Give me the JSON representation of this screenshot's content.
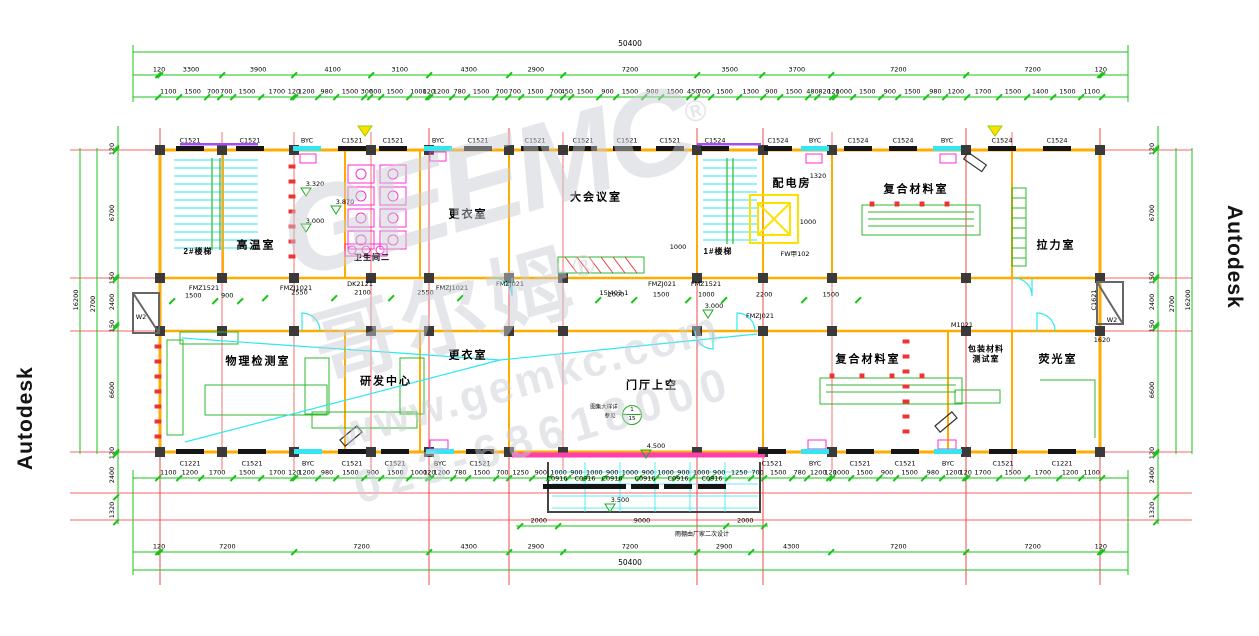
{
  "watermarks": {
    "left_vertical": "Autodesk",
    "right_vertical": "Autodesk",
    "center_logo_latin": "GEEMC",
    "center_logo_cn": "哥尔姆",
    "registered_mark": "®",
    "center_site": "www.gemkc.com",
    "center_phone": "023-68618000"
  },
  "rooms": {
    "gaowen": "高温室",
    "weishengjian": "卫生间二",
    "gengyi_top": "更衣室",
    "dahuiyi": "大会议室",
    "peidian": "配电房",
    "fuhe_top": "复合材料室",
    "lali": "拉力室",
    "wuli": "物理检测室",
    "yanfa": "研发中心",
    "gengyi_bottom": "更衣室",
    "menting": "门厅上空",
    "fuhe_bottom": "复合材料室",
    "baozhuang": "包装材料\n测试室",
    "yingguang": "荧光室",
    "stair2": "2#楼梯",
    "stair1": "1#楼梯"
  },
  "window_labels": {
    "top": [
      "C1521",
      "C1521",
      "BYC",
      "C1521",
      "C1521",
      "BYC",
      "C1521",
      "C1521",
      "C1521",
      "C1521",
      "C1521",
      "C1524",
      "C1524",
      "BYC",
      "C1524",
      "C1524",
      "BYC",
      "C1524",
      "C1524"
    ],
    "bottom": [
      "C1221",
      "C1521",
      "BYC",
      "C1521",
      "C1521",
      "BYC",
      "C1521",
      "C1521",
      "BYC",
      "C1521",
      "C1521",
      "BYC",
      "C1521",
      "C1221"
    ],
    "canopy": [
      "C0916",
      "C0916",
      "C0916",
      "C0916",
      "C0916",
      "C0916"
    ]
  },
  "dims": {
    "top_total": "50400",
    "bottom_total": "50400",
    "left_total": "16200",
    "right_total": "16200",
    "left_mid": "2700",
    "right_mid": "2700",
    "top_axis": [
      120,
      3300,
      3900,
      4100,
      3100,
      4300,
      2900,
      7200,
      3500,
      3700,
      7200,
      7200,
      120
    ],
    "top_detail": [
      1100,
      1500,
      700,
      700,
      1500,
      1700,
      120,
      1200,
      980,
      1500,
      300,
      600,
      1500,
      1000,
      120,
      1200,
      780,
      1500,
      700,
      700,
      1500,
      700,
      450,
      1500,
      900,
      1500,
      900,
      1500,
      450,
      700,
      1500,
      1300,
      900,
      1500,
      480,
      820,
      120,
      1000,
      1500,
      900,
      1500,
      980,
      1200,
      1700,
      1500,
      1400,
      1500,
      1100
    ],
    "bottom_detail": [
      1100,
      1200,
      1700,
      1500,
      1700,
      120,
      1200,
      980,
      1500,
      900,
      1500,
      1000,
      120,
      1200,
      780,
      1500,
      700,
      1250,
      900,
      1000,
      900,
      1000,
      900,
      1000,
      900,
      1000,
      900,
      1000,
      900,
      1250,
      700,
      1500,
      780,
      1200,
      120,
      1000,
      1500,
      900,
      1500,
      980,
      1200,
      120,
      1700,
      1500,
      1700,
      1200,
      1100
    ],
    "bottom_axis": [
      120,
      7200,
      7200,
      4300,
      2900,
      7200,
      2900,
      4300,
      7200,
      7200,
      120
    ],
    "canopy": [
      2000,
      9000,
      2000
    ],
    "corridor": [
      2550,
      2100,
      2550
    ],
    "mid_door": [
      1000,
      1500,
      1000,
      2200,
      1500
    ],
    "left_door": [
      1500,
      900
    ],
    "left_inner": [
      120,
      6700,
      150,
      2400,
      150,
      6600,
      120
    ],
    "left_below": [
      2400,
      1320
    ],
    "right_inner": [
      120,
      6700,
      150,
      2400,
      150,
      6600,
      120
    ],
    "right_below": [
      2400,
      1320
    ]
  },
  "annotations": {
    "w2_left": "W2",
    "fmz1521_left": "FMZ1521",
    "fmzj1021_a": "FMZJ1021",
    "dk2121": "DK2121",
    "fmzj1021_b": "FMZJ1021",
    "fmzj021_a": "FMZJ021",
    "ref15j": "15J403-1",
    "fmzj021_b2": "FMZJ021",
    "fmz1521_mid": "FMZ1521",
    "lvl3000_mid": "3.000",
    "fmzj021_c": "FMZJ021",
    "m1021": "M1021",
    "w2_right": "W2",
    "c1621_right": "C1621",
    "d1620": "1620",
    "lvl3320": "3.320",
    "lvl3870": "3.870",
    "lvl3000": "3.000",
    "d1320": "1320",
    "d1000a": "1000",
    "fw102": "FW甲102",
    "d1000b": "1000",
    "lvl4500": "4.500",
    "lvl3500": "3.500",
    "canopy_note": "雨棚由厂家二次设计"
  },
  "callout": {
    "top": "1",
    "bottom": "15",
    "note1": "图集大样详",
    "note2": "参见"
  }
}
